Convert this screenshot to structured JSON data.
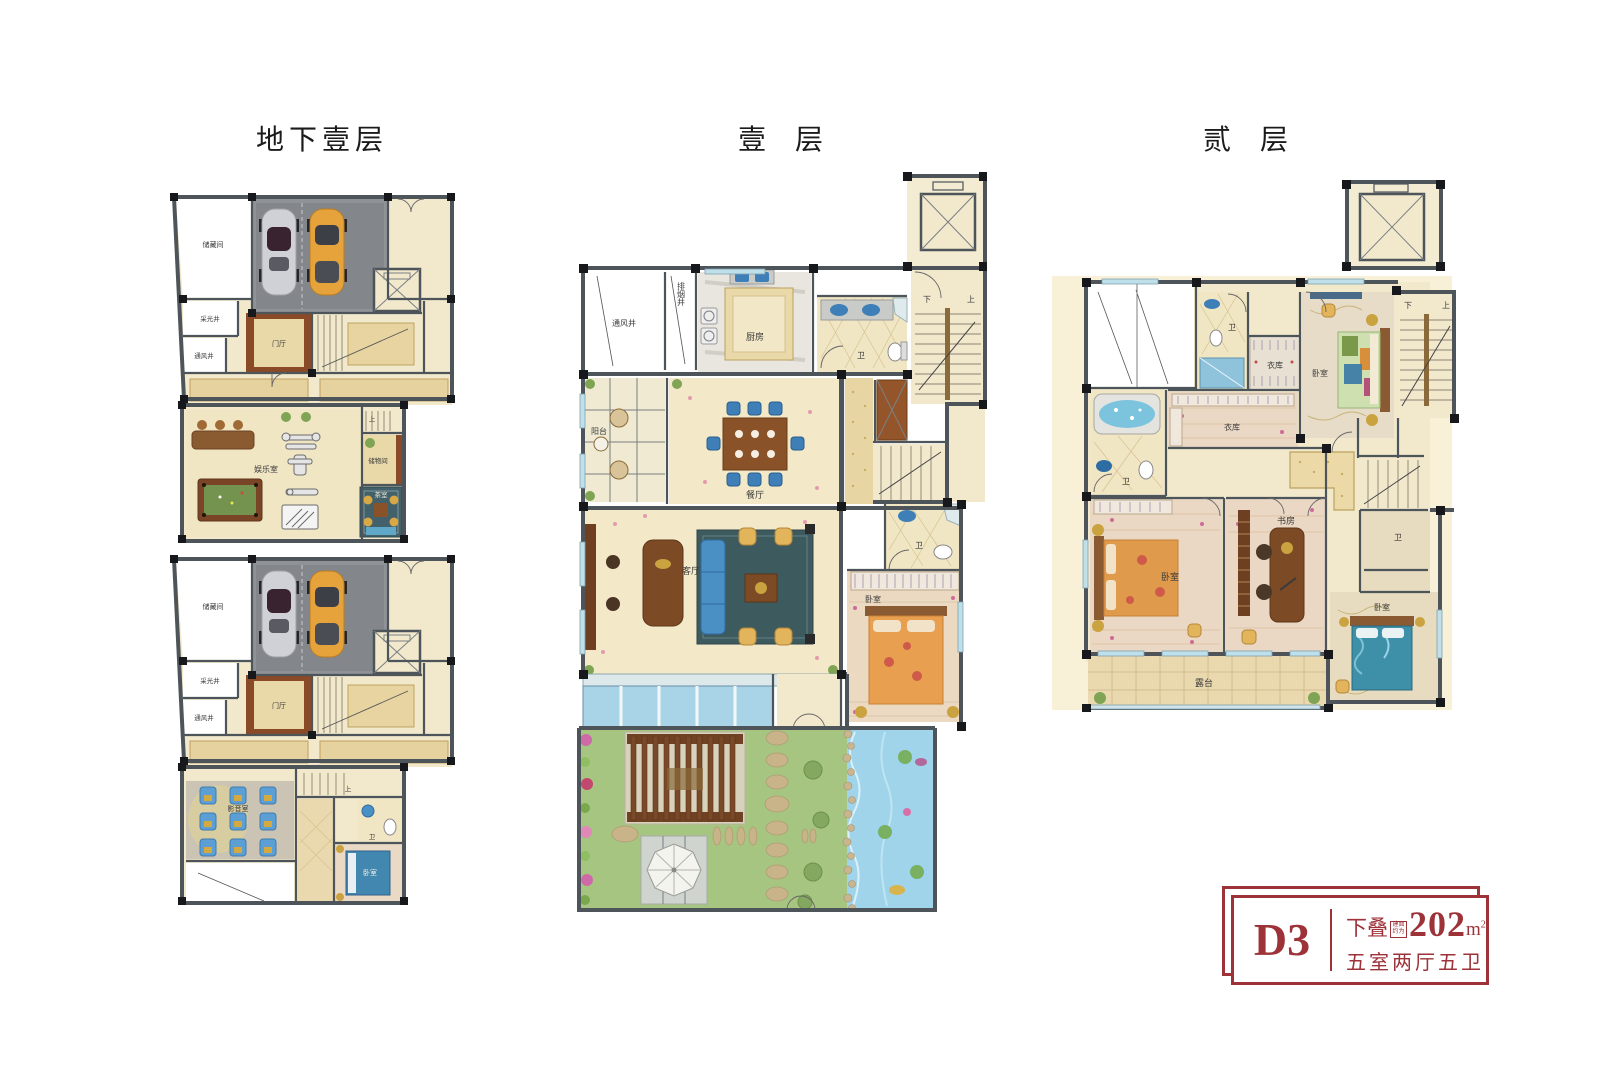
{
  "titles": {
    "basement": "地下壹层",
    "level1": "壹  层",
    "level2": "贰  层"
  },
  "badge": {
    "unit": "D3",
    "type": "下叠",
    "stamp_top": "建面",
    "stamp_bottom": "约为",
    "area": "202",
    "area_unit": "m",
    "area_sup": "2",
    "rooms": "五室两厅五卫",
    "accent": "#9d3238"
  },
  "labels": {
    "b1": {
      "storage": "储藏间",
      "light": "采光井",
      "vent": "通风井",
      "foyer": "门厅",
      "rec": "娱乐室",
      "store": "储物间",
      "tea": "茶室",
      "up": "上"
    },
    "b2": {
      "storage": "储藏间",
      "light": "采光井",
      "vent": "通风井",
      "foyer": "门厅",
      "cinema": "影音室",
      "bath": "卫",
      "bed": "卧室",
      "up": "上"
    },
    "f1": {
      "vent": "通风井",
      "smoke": "排烟井",
      "kitchen": "厨房",
      "bath": "卫",
      "balcony": "阳台",
      "dining": "餐厅",
      "living": "客厅",
      "bath2": "卫",
      "bed": "卧室",
      "down": "下",
      "up": "上"
    },
    "f2": {
      "bath1": "卫",
      "closet1": "衣库",
      "bed1": "卧室",
      "down": "下",
      "up": "上",
      "bath2": "卫",
      "closet2": "衣库",
      "bed2": "卧室",
      "study": "书房",
      "bath3": "卫",
      "bed3": "卧室",
      "terrace": "露台"
    }
  }
}
